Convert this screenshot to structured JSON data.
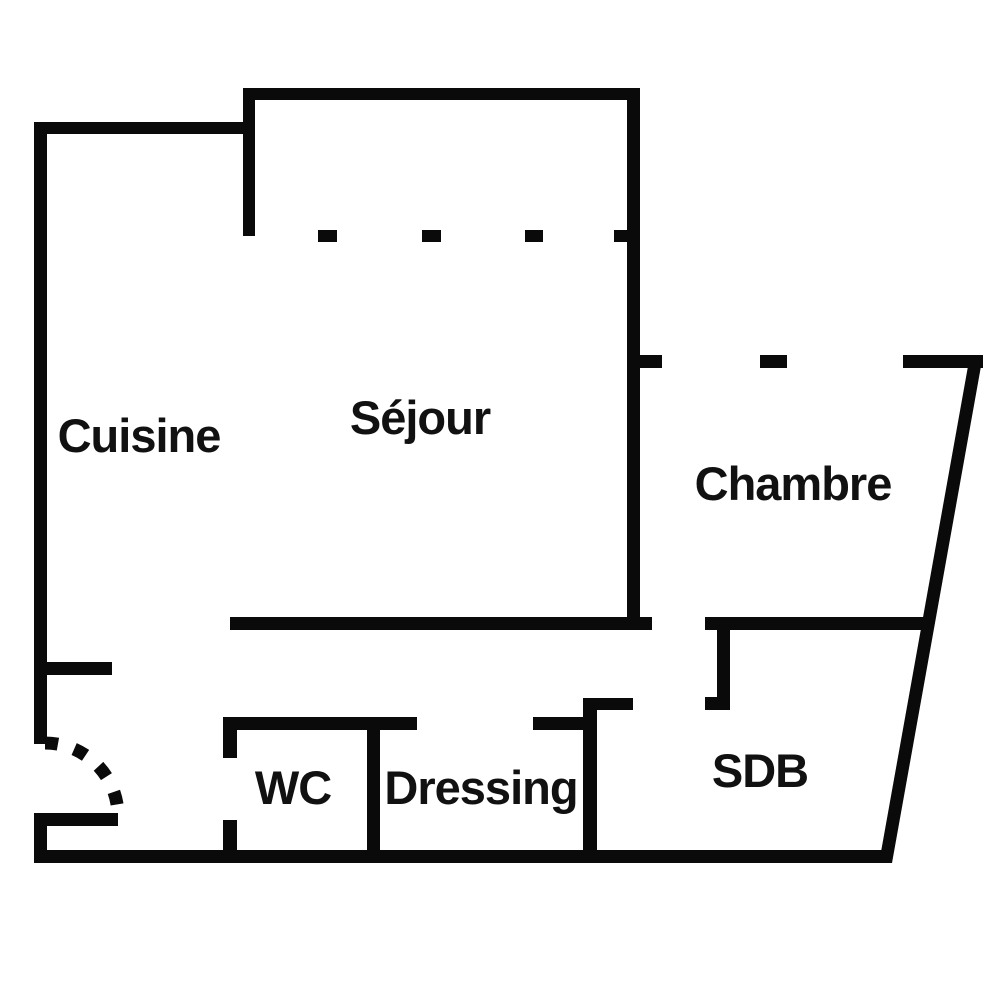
{
  "title": "Apartment floor plan",
  "colors": {
    "wall": "#0a0a0a",
    "text": "#111111",
    "background": "#ffffff"
  },
  "rooms": [
    {
      "id": "cuisine",
      "label": "Cuisine"
    },
    {
      "id": "sejour",
      "label": "Séjour"
    },
    {
      "id": "chambre",
      "label": "Chambre"
    },
    {
      "id": "wc",
      "label": "WC"
    },
    {
      "id": "dressing",
      "label": "Dressing"
    },
    {
      "id": "sdb",
      "label": "SDB"
    }
  ]
}
